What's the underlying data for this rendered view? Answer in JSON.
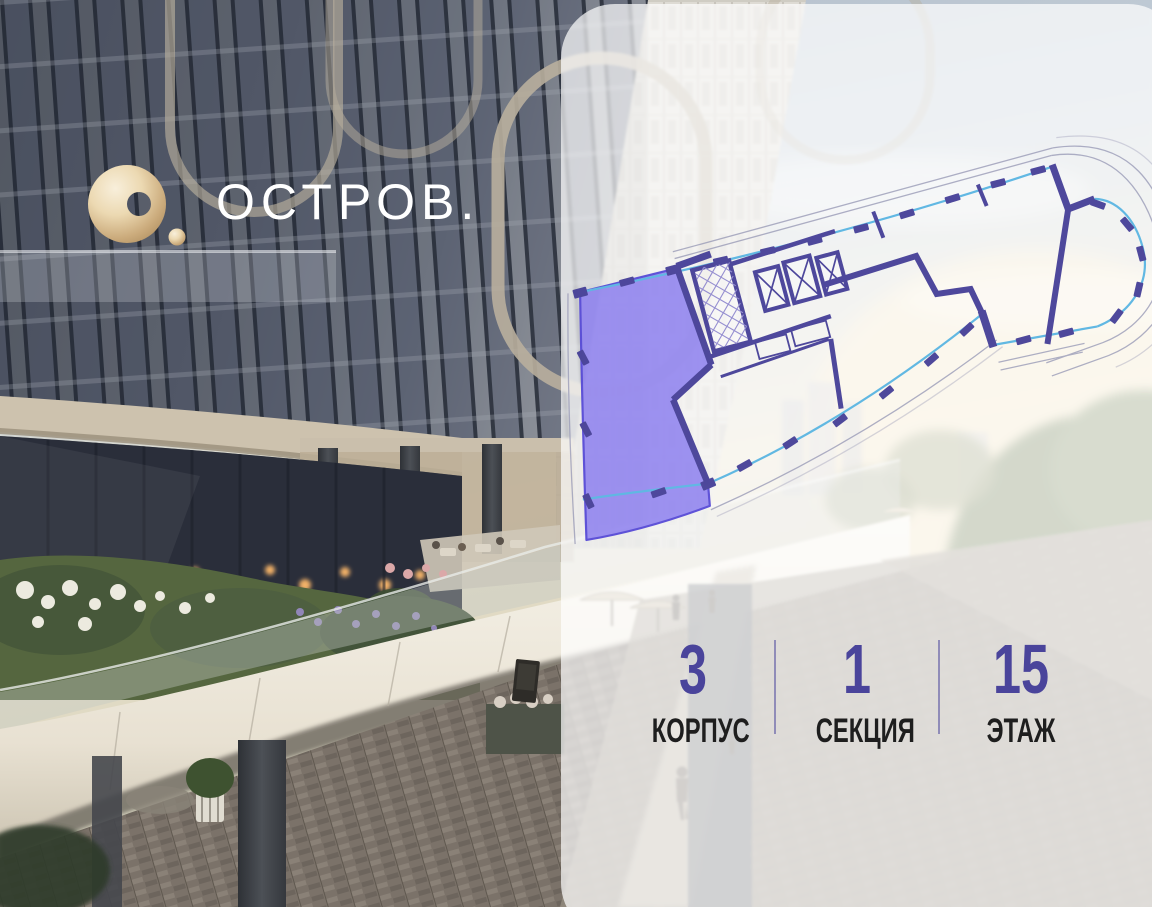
{
  "logo": {
    "mark_icon": "ostrov-ring-icon",
    "text": "ОСТРОВ.",
    "mark_color": "#cbab7c",
    "text_color": "#ffffff"
  },
  "floor_plan": {
    "description": "rotated-floor-plan-with-highlighted-apartment",
    "highlight_fill": "#8678ee",
    "highlight_stroke": "#5649d6",
    "wall_color": "#433d96",
    "glazing_color": "#58b4e2",
    "outline_color": "#9b9cb8"
  },
  "info": {
    "accent_color": "#4a449b",
    "items": [
      {
        "value": "3",
        "label": "КОРПУС"
      },
      {
        "value": "1",
        "label": "СЕКЦИЯ"
      },
      {
        "value": "15",
        "label": "ЭТАЖ"
      }
    ]
  }
}
